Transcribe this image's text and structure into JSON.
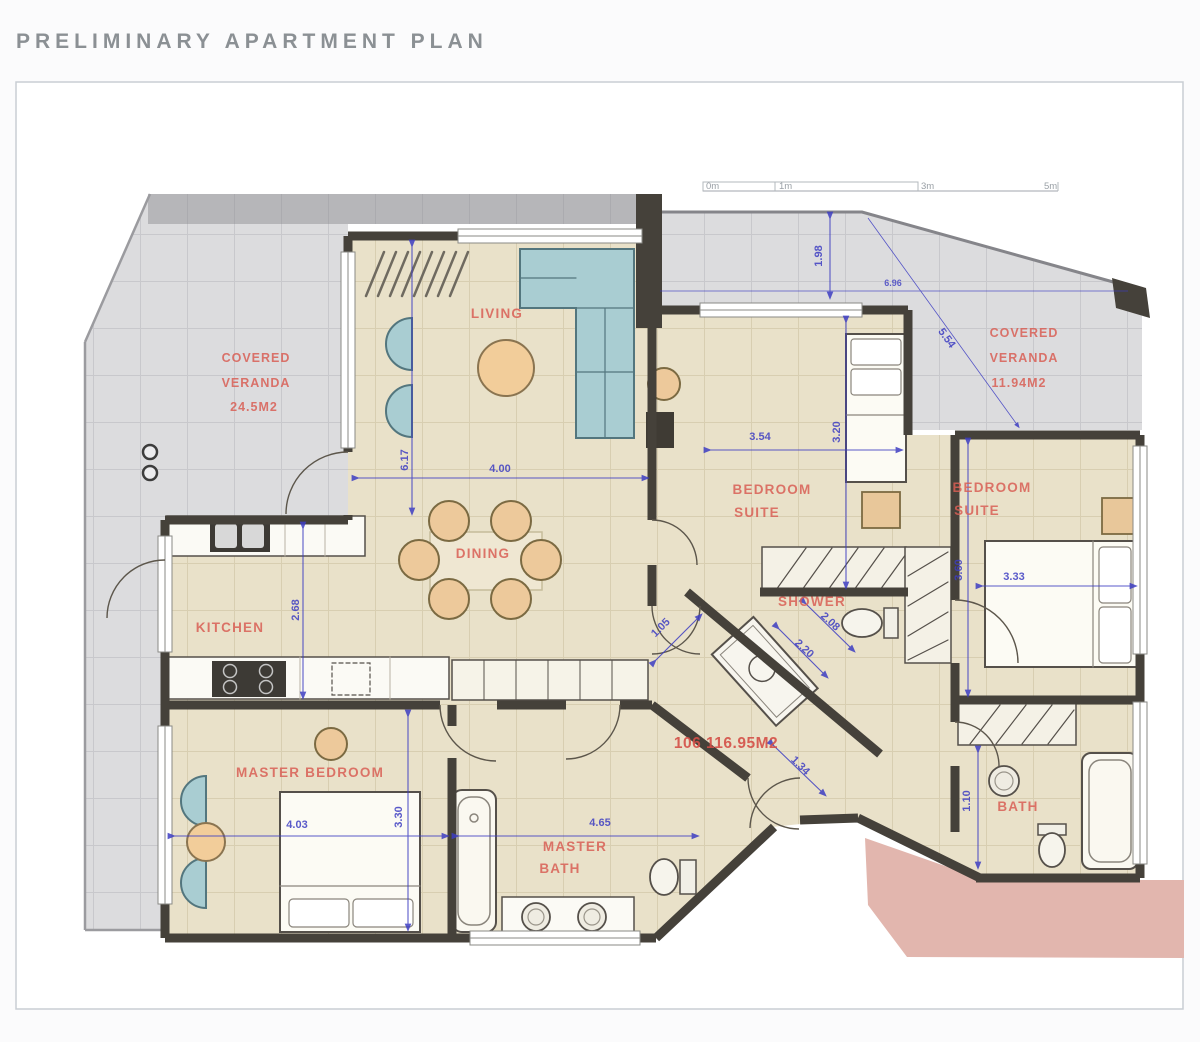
{
  "page": {
    "title": "PRELIMINARY APARTMENT PLAN"
  },
  "scale_bar": {
    "labels": [
      "0m",
      "1m",
      "3m",
      "5m"
    ]
  },
  "unit": {
    "label": "106 116.95M2"
  },
  "rooms": {
    "living": "LIVING",
    "dining": "DINING",
    "kitchen": "KITCHEN",
    "master_bedroom": "MASTER BEDROOM",
    "master_bath_line1": "MASTER",
    "master_bath_line2": "BATH",
    "shower": "SHOWER",
    "bath": "BATH",
    "suite1_line1": "BEDROOM",
    "suite1_line2": "SUITE",
    "suite2_line1": "BEDROOM",
    "suite2_line2": "SUITE",
    "veranda_left_line1": "COVERED",
    "veranda_left_line2": "VERANDA",
    "veranda_left_area": "24.5M2",
    "veranda_right_line1": "COVERED",
    "veranda_right_line2": "VERANDA",
    "veranda_right_area": "11.94M2"
  },
  "dimensions": {
    "living_depth": "6.17",
    "living_width": "4.00",
    "kitchen_depth": "2.68",
    "suite1_width": "3.54",
    "suite1_depth": "3.20",
    "suite2_depth": "3.60",
    "suite2_width": "3.33",
    "master_width": "4.03",
    "master_depth": "3.30",
    "master_bath_width": "4.65",
    "bath_width": "1.10",
    "hall_a": "1.05",
    "hall_b": "2.08",
    "hall_c": "2.20",
    "hall_d": "1.34",
    "veranda_depth": "1.98",
    "veranda_width": "6.96",
    "veranda_diag": "5.54"
  },
  "colors": {
    "wall": "#45413a",
    "floor_tile": "#e9e1c9",
    "veranda_tile": "#dcdcde",
    "label_red": "#d95f55",
    "dim_blue": "#3d3dc2",
    "pink_area": "#e2b6ae",
    "furniture_teal": "#a9cdd2",
    "furniture_tan": "#edc99b"
  }
}
